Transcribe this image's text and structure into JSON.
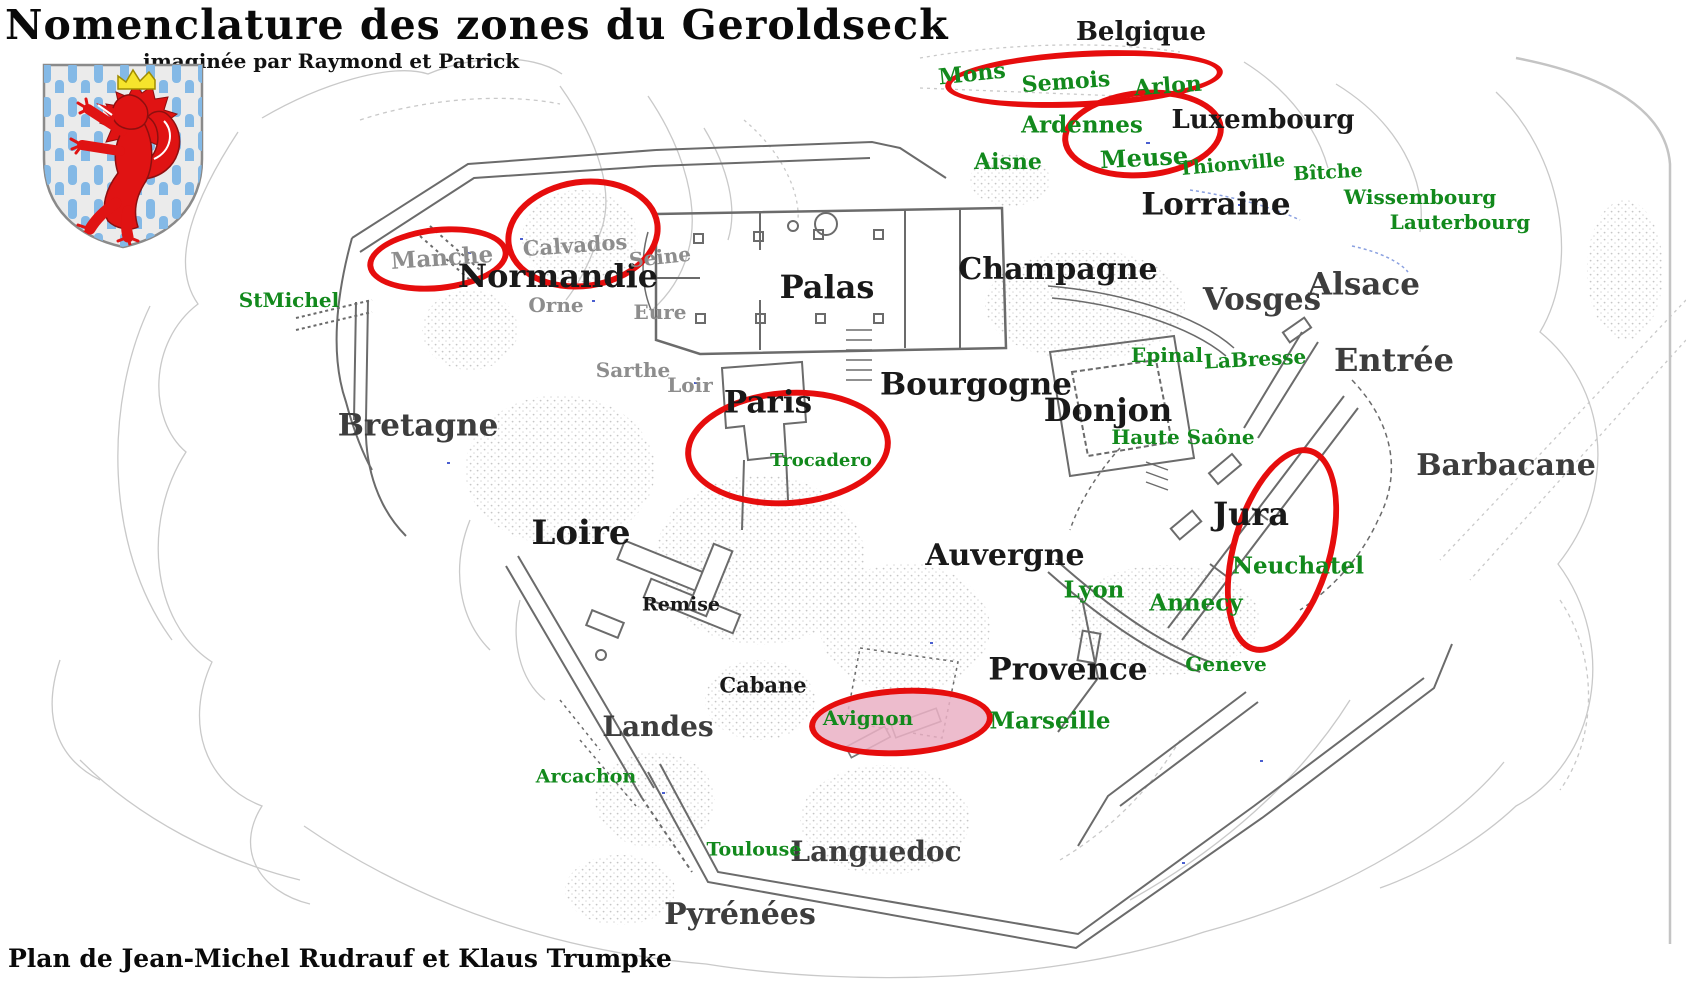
{
  "title": "Nomenclature des zones du Geroldseck",
  "subtitle": "imaginée par Raymond et Patrick",
  "credit": "Plan de Jean-Michel Rudrauf et Klaus Trumpke",
  "colors": {
    "label_black": "#191919",
    "label_dark": "#3d3d3d",
    "label_gray": "#8d8d8d",
    "label_green": "#12891c",
    "highlight_red": "#e60d0d",
    "highlight_pink_fill": "rgba(234,176,196,0.85)",
    "shield_blue": "#84b9e6",
    "shield_lion_red": "#e01313",
    "crown_yellow": "#f5e42c"
  },
  "map": {
    "labels": [
      {
        "id": "belgique",
        "text": "Belgique",
        "x": 1141,
        "y": 32,
        "fs": 26,
        "color": "black"
      },
      {
        "id": "luxembourg",
        "text": "Luxembourg",
        "x": 1263,
        "y": 120,
        "fs": 26,
        "color": "black"
      },
      {
        "id": "lorraine",
        "text": "Lorraine",
        "x": 1216,
        "y": 205,
        "fs": 31,
        "color": "black"
      },
      {
        "id": "normandie",
        "text": "Normandie",
        "x": 558,
        "y": 276,
        "fs": 32,
        "color": "black"
      },
      {
        "id": "palas",
        "text": "Palas",
        "x": 827,
        "y": 287,
        "fs": 32,
        "color": "black"
      },
      {
        "id": "champagne",
        "text": "Champagne",
        "x": 1058,
        "y": 270,
        "fs": 30,
        "color": "black"
      },
      {
        "id": "bourgogne",
        "text": "Bourgogne",
        "x": 976,
        "y": 385,
        "fs": 31,
        "color": "black"
      },
      {
        "id": "paris",
        "text": "Paris",
        "x": 768,
        "y": 403,
        "fs": 31,
        "color": "black"
      },
      {
        "id": "donjon",
        "text": "Donjon",
        "x": 1108,
        "y": 410,
        "fs": 32,
        "color": "black"
      },
      {
        "id": "loire",
        "text": "Loire",
        "x": 581,
        "y": 533,
        "fs": 34,
        "color": "black"
      },
      {
        "id": "auvergne",
        "text": "Auvergne",
        "x": 1005,
        "y": 556,
        "fs": 30,
        "color": "black"
      },
      {
        "id": "jura",
        "text": "Jura",
        "x": 1251,
        "y": 514,
        "fs": 32,
        "color": "black"
      },
      {
        "id": "provence",
        "text": "Provence",
        "x": 1068,
        "y": 670,
        "fs": 31,
        "color": "black"
      },
      {
        "id": "remise",
        "text": "Remise",
        "x": 681,
        "y": 605,
        "fs": 19,
        "color": "black"
      },
      {
        "id": "cabane",
        "text": "Cabane",
        "x": 763,
        "y": 685,
        "fs": 21,
        "color": "black"
      },
      {
        "id": "vosges",
        "text": "Vosges",
        "x": 1262,
        "y": 300,
        "fs": 31,
        "color": "dark"
      },
      {
        "id": "alsace",
        "text": "Alsace",
        "x": 1364,
        "y": 285,
        "fs": 31,
        "color": "dark"
      },
      {
        "id": "entree",
        "text": "Entrée",
        "x": 1394,
        "y": 360,
        "fs": 32,
        "color": "dark"
      },
      {
        "id": "barbacane",
        "text": "Barbacane",
        "x": 1506,
        "y": 466,
        "fs": 30,
        "color": "dark"
      },
      {
        "id": "bretagne",
        "text": "Bretagne",
        "x": 418,
        "y": 426,
        "fs": 31,
        "color": "dark"
      },
      {
        "id": "landes",
        "text": "Landes",
        "x": 658,
        "y": 727,
        "fs": 28,
        "color": "dark"
      },
      {
        "id": "languedoc",
        "text": "Languedoc",
        "x": 876,
        "y": 852,
        "fs": 28,
        "color": "dark"
      },
      {
        "id": "pyrenees",
        "text": "Pyrénées",
        "x": 740,
        "y": 915,
        "fs": 30,
        "color": "dark"
      },
      {
        "id": "manche",
        "text": "Manche",
        "x": 442,
        "y": 258,
        "fs": 23,
        "color": "gray",
        "rot": -4
      },
      {
        "id": "calvados",
        "text": "Calvados",
        "x": 575,
        "y": 245,
        "fs": 21,
        "color": "gray",
        "rot": -4
      },
      {
        "id": "seine",
        "text": "Seine",
        "x": 660,
        "y": 257,
        "fs": 20,
        "color": "gray",
        "rot": -6
      },
      {
        "id": "orne",
        "text": "Orne",
        "x": 556,
        "y": 305,
        "fs": 20,
        "color": "gray"
      },
      {
        "id": "eure",
        "text": "Eure",
        "x": 660,
        "y": 312,
        "fs": 20,
        "color": "gray"
      },
      {
        "id": "sarthe",
        "text": "Sarthe",
        "x": 633,
        "y": 370,
        "fs": 20,
        "color": "gray"
      },
      {
        "id": "loir",
        "text": "Loir",
        "x": 690,
        "y": 385,
        "fs": 20,
        "color": "gray"
      },
      {
        "id": "mons",
        "text": "Mons",
        "x": 972,
        "y": 74,
        "fs": 22,
        "color": "green",
        "rot": -6
      },
      {
        "id": "semois",
        "text": "Semois",
        "x": 1066,
        "y": 82,
        "fs": 22,
        "color": "green",
        "rot": -4
      },
      {
        "id": "arlon",
        "text": "Arlon",
        "x": 1168,
        "y": 86,
        "fs": 22,
        "color": "green",
        "rot": -4
      },
      {
        "id": "ardennes",
        "text": "Ardennes",
        "x": 1082,
        "y": 125,
        "fs": 23,
        "color": "green"
      },
      {
        "id": "aisne",
        "text": "Aisne",
        "x": 1008,
        "y": 162,
        "fs": 22,
        "color": "green"
      },
      {
        "id": "meuse",
        "text": "Meuse",
        "x": 1144,
        "y": 158,
        "fs": 24,
        "color": "green",
        "rot": -3
      },
      {
        "id": "thionville",
        "text": "Thionville",
        "x": 1232,
        "y": 165,
        "fs": 19,
        "color": "green",
        "rot": -5
      },
      {
        "id": "bitche",
        "text": "Bîtche",
        "x": 1328,
        "y": 173,
        "fs": 19,
        "color": "green",
        "rot": -3
      },
      {
        "id": "wissembourg",
        "text": "Wissembourg",
        "x": 1420,
        "y": 197,
        "fs": 20,
        "color": "green"
      },
      {
        "id": "lauterbourg",
        "text": "Lauterbourg",
        "x": 1460,
        "y": 222,
        "fs": 20,
        "color": "green"
      },
      {
        "id": "epinal",
        "text": "Epinal",
        "x": 1167,
        "y": 355,
        "fs": 20,
        "color": "green"
      },
      {
        "id": "labresse",
        "text": "LaBresse",
        "x": 1255,
        "y": 359,
        "fs": 20,
        "color": "green",
        "rot": -3
      },
      {
        "id": "haute-saone",
        "text": "Haute Saône",
        "x": 1183,
        "y": 437,
        "fs": 20,
        "color": "green"
      },
      {
        "id": "stmichel",
        "text": "StMichel",
        "x": 289,
        "y": 300,
        "fs": 20,
        "color": "green"
      },
      {
        "id": "trocadero",
        "text": "Trocadero",
        "x": 821,
        "y": 461,
        "fs": 18,
        "color": "green"
      },
      {
        "id": "neuchatel",
        "text": "Neuchatel",
        "x": 1298,
        "y": 566,
        "fs": 23,
        "color": "green"
      },
      {
        "id": "lyon",
        "text": "Lyon",
        "x": 1094,
        "y": 590,
        "fs": 23,
        "color": "green"
      },
      {
        "id": "annecy",
        "text": "Annecy",
        "x": 1196,
        "y": 603,
        "fs": 23,
        "color": "green"
      },
      {
        "id": "geneve",
        "text": "Geneve",
        "x": 1226,
        "y": 664,
        "fs": 20,
        "color": "green"
      },
      {
        "id": "avignon",
        "text": "Avignon",
        "x": 868,
        "y": 718,
        "fs": 20,
        "color": "green"
      },
      {
        "id": "marseille",
        "text": "Marseille",
        "x": 1050,
        "y": 721,
        "fs": 23,
        "color": "green"
      },
      {
        "id": "arcachon",
        "text": "Arcachon",
        "x": 586,
        "y": 777,
        "fs": 19,
        "color": "green"
      },
      {
        "id": "toulouse",
        "text": "Toulouse",
        "x": 754,
        "y": 850,
        "fs": 19,
        "color": "green"
      }
    ],
    "highlights": [
      {
        "id": "ellipse-mons-semois-arlon",
        "cx": 1084,
        "cy": 79,
        "w": 278,
        "h": 56,
        "rot": -3,
        "filled": false
      },
      {
        "id": "ellipse-ardennes-meuse",
        "cx": 1143,
        "cy": 134,
        "w": 162,
        "h": 88,
        "rot": -5,
        "filled": false
      },
      {
        "id": "ellipse-manche",
        "cx": 438,
        "cy": 259,
        "w": 142,
        "h": 64,
        "rot": -6,
        "filled": false
      },
      {
        "id": "ellipse-calvados",
        "cx": 583,
        "cy": 234,
        "w": 156,
        "h": 110,
        "rot": -8,
        "filled": false
      },
      {
        "id": "ellipse-paris-trocadero",
        "cx": 788,
        "cy": 448,
        "w": 206,
        "h": 116,
        "rot": -4,
        "filled": false
      },
      {
        "id": "ellipse-jura-neuchatel",
        "cx": 1282,
        "cy": 550,
        "w": 102,
        "h": 212,
        "rot": 16,
        "filled": false
      },
      {
        "id": "ellipse-avignon",
        "cx": 901,
        "cy": 722,
        "w": 184,
        "h": 68,
        "rot": -3,
        "filled": true
      }
    ]
  }
}
